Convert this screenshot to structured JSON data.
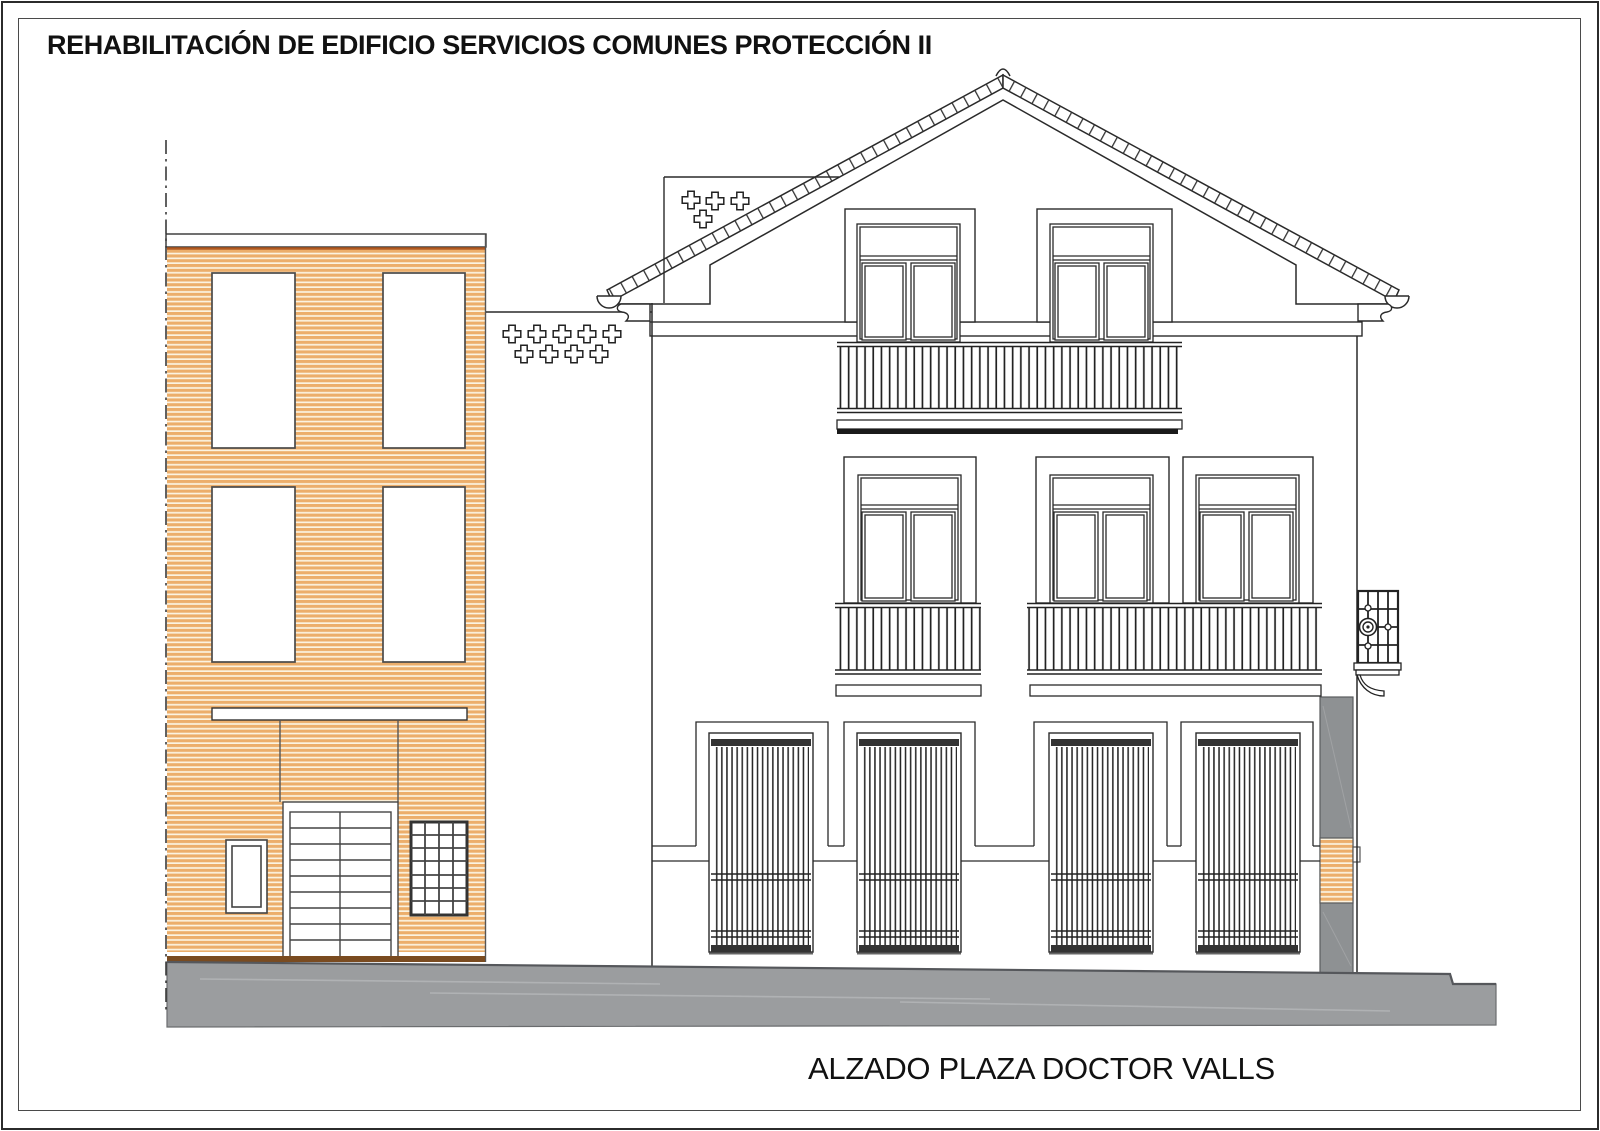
{
  "page": {
    "sheet_title": "REHABILITACIÓN DE EDIFICIO SERVICIOS COMUNES PROTECCIÓN II",
    "drawing_caption": "ALZADO PLAZA DOCTOR VALLS"
  },
  "colors": {
    "line": "#2a2a2a",
    "hatch_stripe": "#ecae6b",
    "hatch_gap": "#fbf3e1",
    "coping_red": "#b2591f",
    "base_brown": "#7a4b20",
    "ground_gray": "#9b9d9f",
    "ground_edge": "#55575b",
    "neighbor_gray": "#8e9193",
    "grille_dark": "#333333",
    "paper": "#ffffff"
  }
}
